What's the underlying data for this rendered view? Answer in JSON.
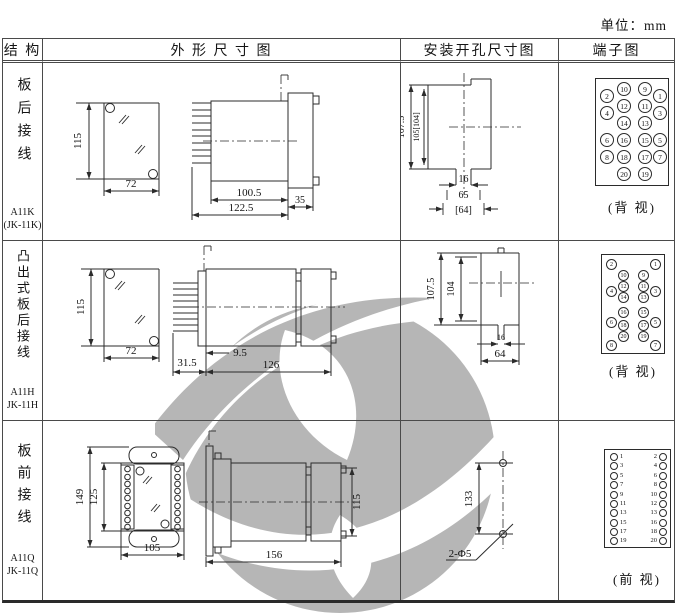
{
  "unit_label": "单位：mm",
  "header": {
    "structure": "结 构",
    "outline": "外 形 尺 寸 图",
    "mounting": "安装开孔尺寸图",
    "terminal": "端子图"
  },
  "colors": {
    "line": "#2b2b2b",
    "watermark": "#b6b6b6"
  },
  "rows": [
    {
      "structure": "板后接线",
      "model": "A11K",
      "model2": "(JK-11K)",
      "outline": {
        "h": "115",
        "w": "72",
        "body": "100.5",
        "total": "122.5",
        "flange": "35"
      },
      "mounting": {
        "outer": "107.5",
        "inner": "105[104]",
        "slot": "16",
        "span": "65",
        "span_alt": "[64]"
      },
      "terminal": {
        "caption": "(背 视)",
        "outer_left": [
          "2",
          "4",
          "6",
          "8"
        ],
        "inner_left": [
          "10",
          "12",
          "14",
          "16",
          "18",
          "20"
        ],
        "inner_right": [
          "9",
          "11",
          "13",
          "15",
          "17",
          "19"
        ],
        "outer_right": [
          "1",
          "3",
          "5",
          "7"
        ]
      }
    },
    {
      "structure": "凸出式板后接线",
      "model": "A11H",
      "model2": "JK-11H",
      "outline": {
        "h": "115",
        "w": "72",
        "pin": "31.5",
        "offset": "9.5",
        "total": "126"
      },
      "mounting": {
        "outer": "107.5",
        "inner": "104",
        "slot": "16",
        "span": "64"
      },
      "terminal": {
        "caption": "(背 视)",
        "outer_left": [
          "2",
          "4",
          "6",
          "8"
        ],
        "inner_left": [
          "10",
          "12",
          "14",
          "16",
          "18",
          "20"
        ],
        "inner_right": [
          "9",
          "11",
          "13",
          "15",
          "17",
          "19"
        ],
        "outer_right": [
          "1",
          "3",
          "5",
          "7"
        ]
      }
    },
    {
      "structure": "板前接线",
      "model": "A11Q",
      "model2": "JK-11Q",
      "outline": {
        "h_outer": "149",
        "h_inner": "125",
        "w": "105",
        "total": "156",
        "depth": "115"
      },
      "mounting": {
        "spacing": "133",
        "holes": "2-Φ5"
      },
      "terminal": {
        "caption": "(前 视)",
        "left": [
          "1",
          "3",
          "5",
          "7",
          "9",
          "11",
          "13",
          "15",
          "17",
          "19"
        ],
        "right": [
          "2",
          "4",
          "6",
          "8",
          "10",
          "12",
          "13",
          "16",
          "18",
          "20"
        ]
      }
    }
  ]
}
